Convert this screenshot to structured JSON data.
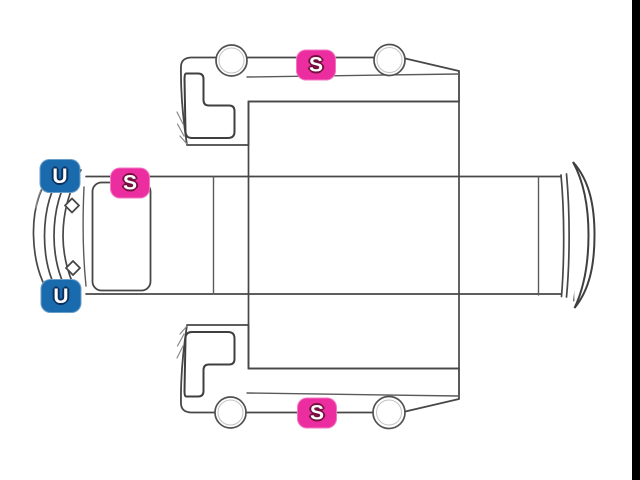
{
  "canvas": {
    "background": "#ffffff",
    "right_bar_color": "#000000"
  },
  "diagram": {
    "description": "truck-cab-unfolded-condition-diagram",
    "line_color": "#474747",
    "marker_styles": {
      "S": {
        "fill": "#ec2d9f",
        "outline": "#73103f"
      },
      "U": {
        "fill": "#1a6bad",
        "outline": "#0d2f5c"
      }
    },
    "markers": [
      {
        "id": "marker-s-top-side",
        "code": "S",
        "x": 316,
        "y": 65
      },
      {
        "id": "marker-u-front-upper",
        "code": "U",
        "x": 60,
        "y": 176
      },
      {
        "id": "marker-s-front-top",
        "code": "S",
        "x": 130,
        "y": 183
      },
      {
        "id": "marker-u-front-lower",
        "code": "U",
        "x": 61,
        "y": 296
      },
      {
        "id": "marker-s-bottom-side",
        "code": "S",
        "x": 317,
        "y": 413
      }
    ]
  }
}
